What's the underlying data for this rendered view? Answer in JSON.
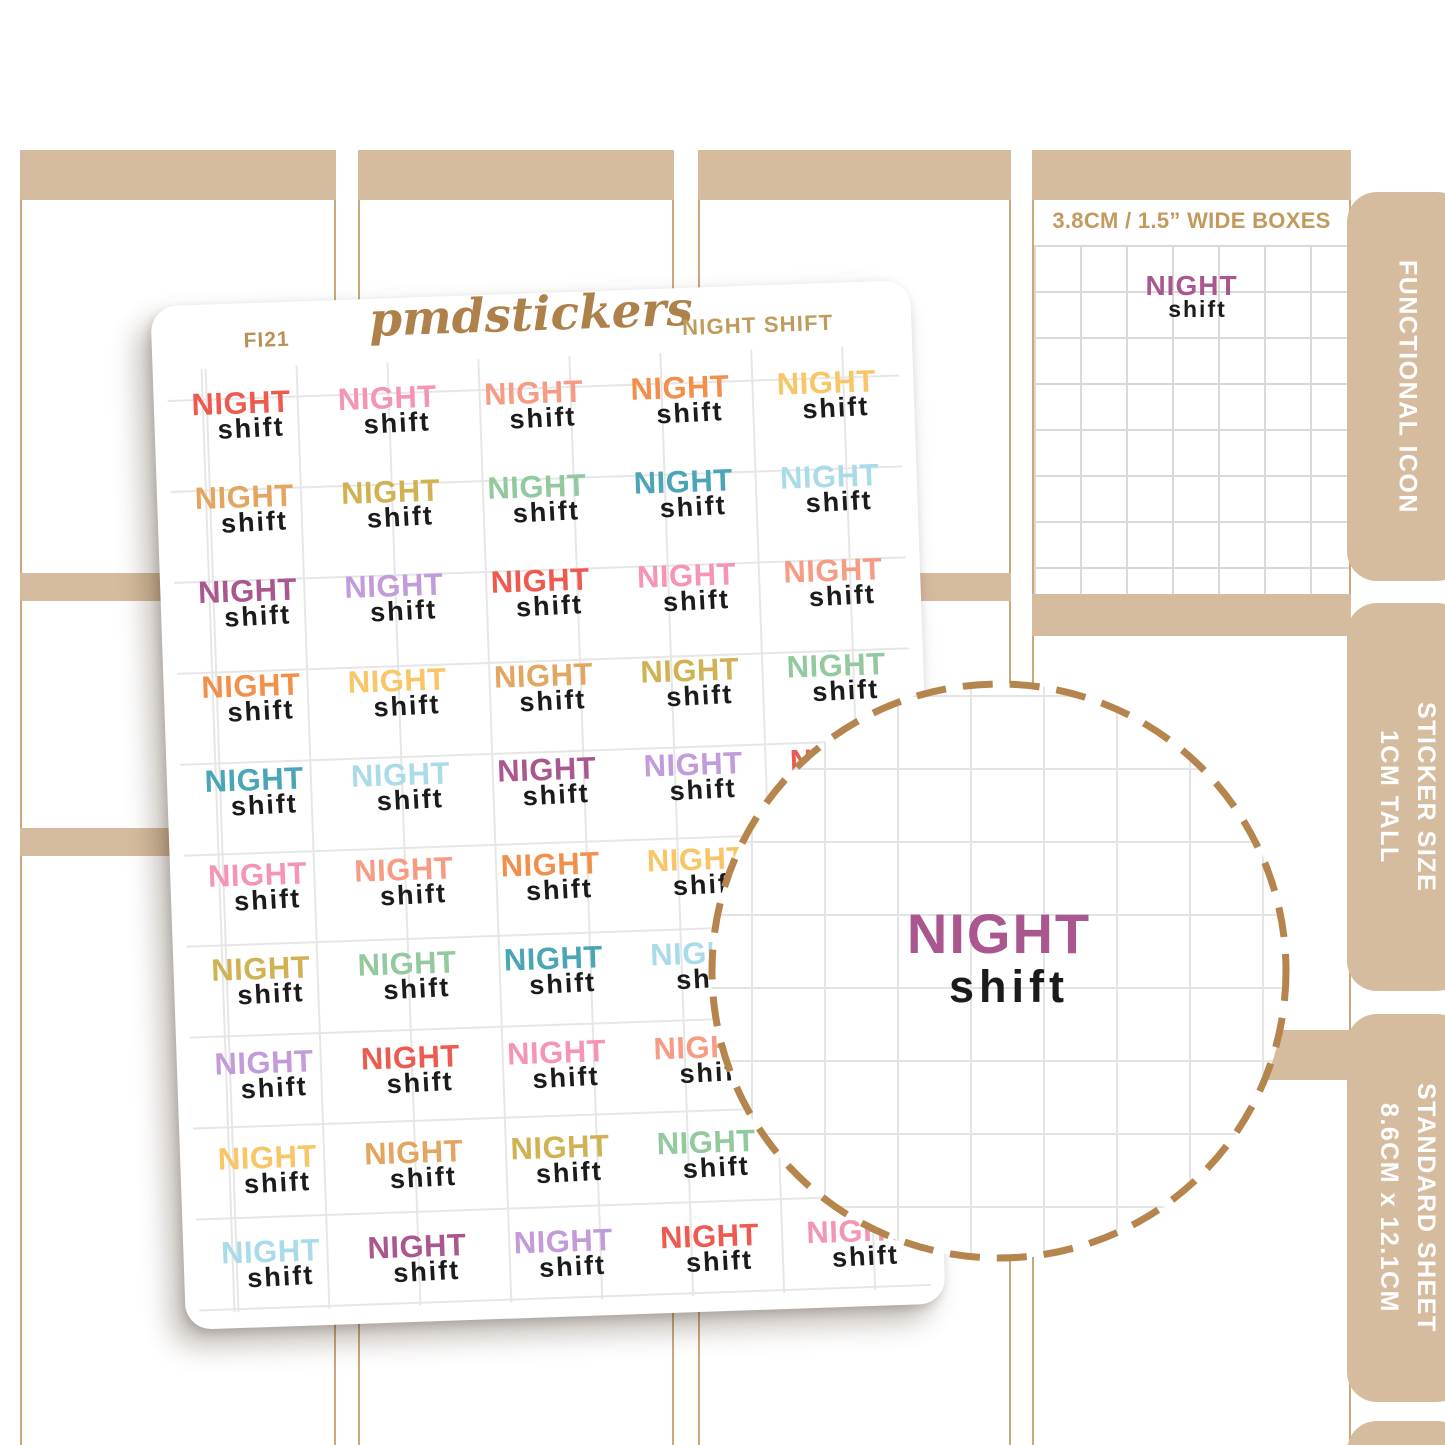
{
  "colors": {
    "tan": "#d5bc9e",
    "line_tan": "#c9a87c",
    "gold_script": "#ad8149",
    "gold_code": "#b9905a",
    "gold_title": "#bf9c5a",
    "gold_panel": "#c39a5e",
    "plum": "#a9578e",
    "ring": "#b5854d",
    "ink": "#1b1b1b"
  },
  "sheet": {
    "code": "FI21",
    "brand": "pmdstickers",
    "title": "NIGHT SHIFT",
    "rows": 10,
    "cols": 5,
    "sticker": {
      "top": "NIGHT",
      "bottom": "shift"
    },
    "palette": [
      {
        "name": "red",
        "hex": "#ee5950"
      },
      {
        "name": "pink",
        "hex": "#f595b3"
      },
      {
        "name": "salmon",
        "hex": "#f69b84"
      },
      {
        "name": "orange",
        "hex": "#f28f4b"
      },
      {
        "name": "yellow",
        "hex": "#f8c666"
      },
      {
        "name": "tan",
        "hex": "#e2a660"
      },
      {
        "name": "mustard",
        "hex": "#d0b253"
      },
      {
        "name": "green",
        "hex": "#92c99f"
      },
      {
        "name": "teal",
        "hex": "#4aa6b6"
      },
      {
        "name": "light-blue",
        "hex": "#a9dbe9"
      },
      {
        "name": "plum",
        "hex": "#a9578e"
      },
      {
        "name": "lavender",
        "hex": "#c29bda"
      }
    ]
  },
  "size_panel": {
    "header": "3.8CM / 1.5” WIDE BOXES",
    "sticker": {
      "top": "NIGHT",
      "bottom": "shift"
    },
    "sticker_color": "#a9578e"
  },
  "zoom_circle": {
    "sticker": {
      "top": "NIGHT",
      "bottom": "shift"
    },
    "sticker_color": "#a9578e",
    "ring_color": "#b5854d"
  },
  "tabs": [
    {
      "lines": [
        "FUNCTIONAL ICON"
      ]
    },
    {
      "lines": [
        "STICKER SIZE",
        "1CM TALL"
      ]
    },
    {
      "lines": [
        "STANDARD SHEET",
        "8.6CM x 12.1CM"
      ]
    },
    {
      "lines": []
    }
  ]
}
